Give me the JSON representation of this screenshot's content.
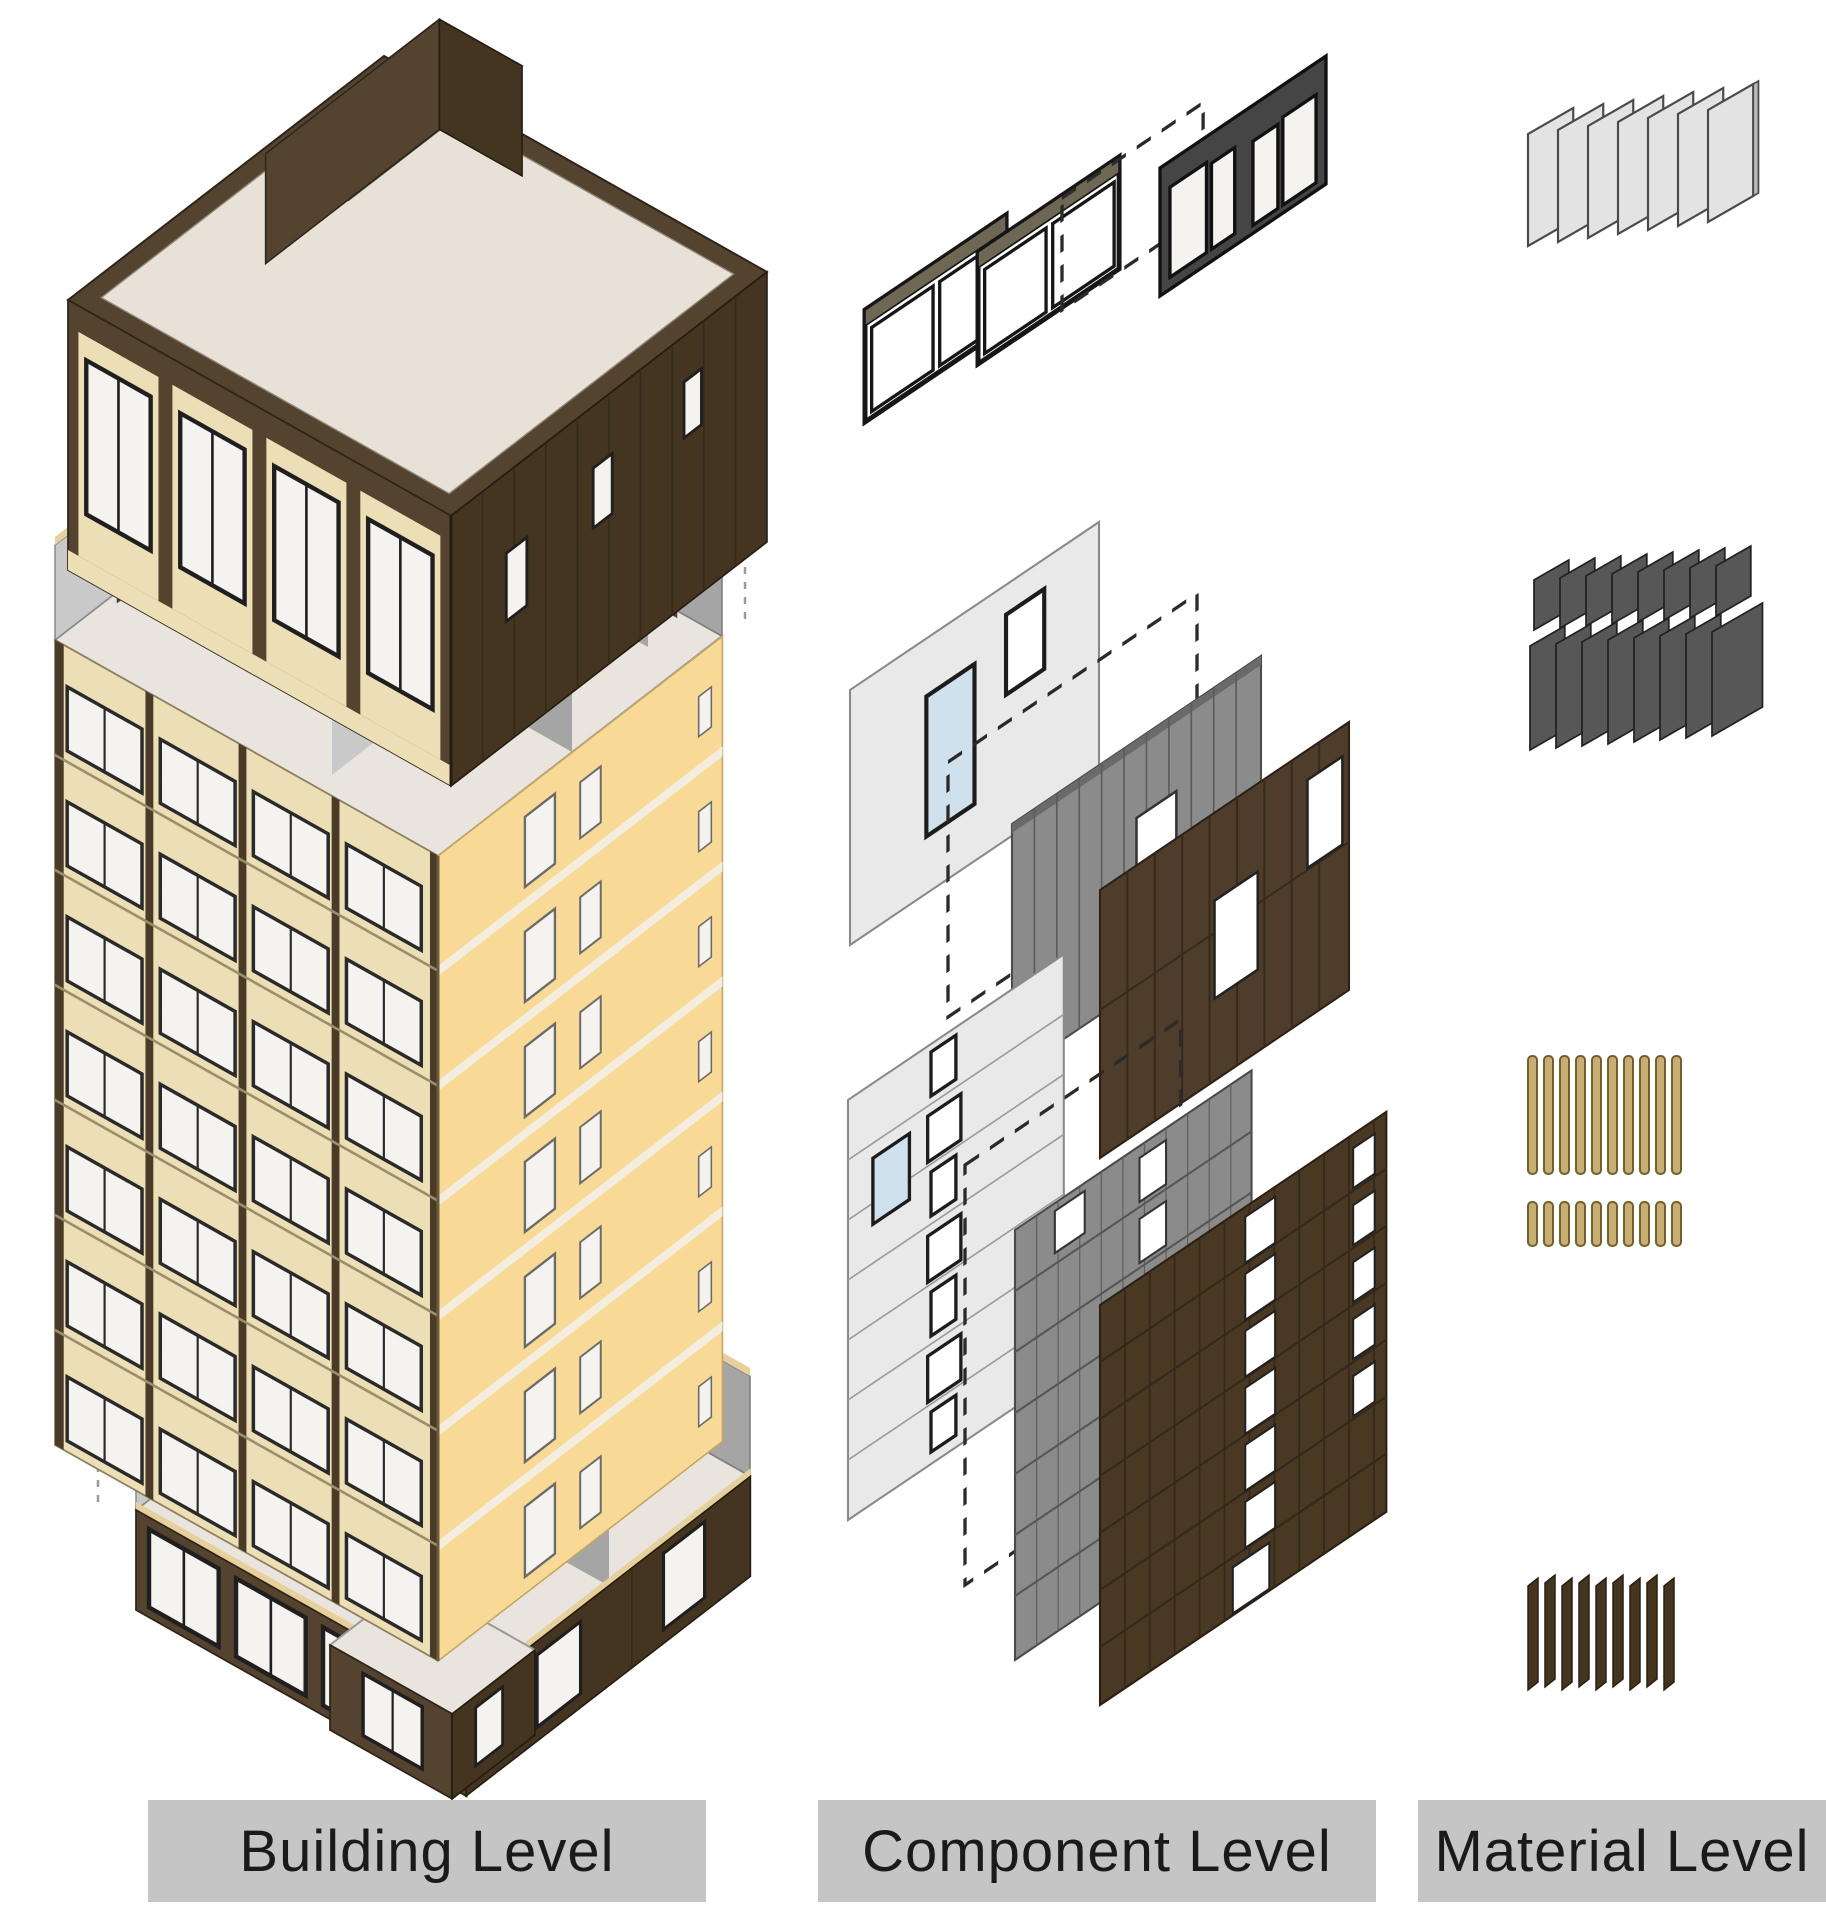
{
  "figure": {
    "type": "exploded-axonometric-diagram",
    "columns": [
      {
        "id": "building-level",
        "label": "Building Level",
        "items": [
          "roof-storey-module",
          "typical-storeys-module",
          "ground-floor-module"
        ]
      },
      {
        "id": "component-level",
        "label": "Component Level",
        "items": [
          "window-frame-set",
          "wall-panel-layer-set",
          "facade-wall-layer-set"
        ]
      },
      {
        "id": "material-level",
        "label": "Material Level",
        "items": [
          "light-board-stack",
          "dark-board-stacks",
          "timber-batten-rows",
          "cladding-plank-stack"
        ]
      }
    ]
  },
  "material_counts": {
    "light_boards": 7,
    "dark_board_rows": [
      8,
      8
    ],
    "timber_batten_rows": [
      10,
      10
    ],
    "cladding_planks": 9
  },
  "colors": {
    "background": "#ffffff",
    "label_bar": "#c5c5c5",
    "label_text": "#1a1a1a",
    "roof_light": "#e8e1d8",
    "cladding_brown": "#54432f",
    "cladding_brown_dark": "#43351f",
    "facade_yellow": "#f8da96",
    "panel_cream": "#ecdfb6",
    "floor_light": "#e9e5de",
    "wood_top": "#e6d09c",
    "interior_gray": "#a5a5a5",
    "interior_gray_light": "#c9c9c9",
    "glass_white": "#f4f3ef",
    "glass_blue": "#cfe1ec",
    "frame_dark": "#1f1f1f",
    "panel_light": "#e9e9e9",
    "panel_gray": "#8b8b8b",
    "board_light": "#e3e3e3",
    "board_gray": "#575757",
    "board_gray_dark": "#3a3a3a",
    "batten_tan": "#c9ae72",
    "batten_edge": "#73602f",
    "plank_brown": "#44351f",
    "guide_gray": "#9a9a9a"
  }
}
